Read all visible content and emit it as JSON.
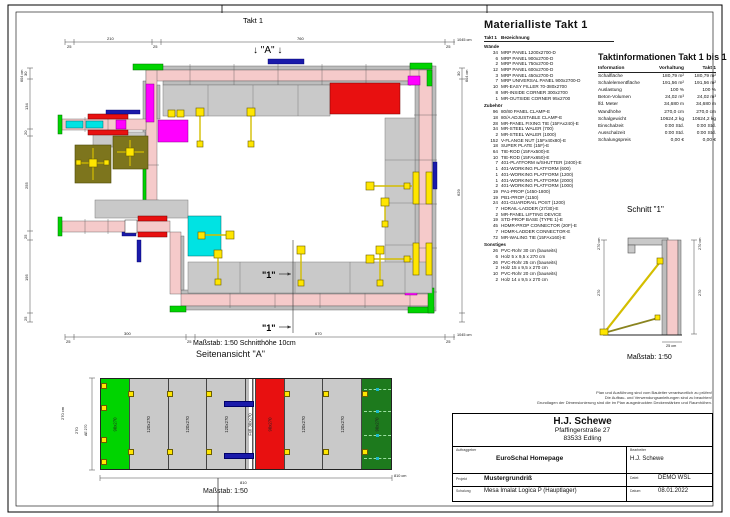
{
  "plan": {
    "title": "Takt 1",
    "view_arrow_label": "↓ \"A\" ↓",
    "section_marker": "\"1\"",
    "scale_note": "Maßstab: 1:50   Schnitthöhe 10cm",
    "dims": {
      "top": [
        "25",
        "210",
        "25",
        "760",
        "25"
      ],
      "top_total": "1045 cm",
      "left": [
        "30",
        "134",
        "20",
        "255",
        "25",
        "195",
        "25"
      ],
      "left_total": "604 cm",
      "right_seg1": "30",
      "right_seg2": "629",
      "right_total": "604 cm",
      "bottom": [
        "25",
        "300",
        "25",
        "670",
        "25"
      ],
      "bottom_total": "1045 cm"
    }
  },
  "side_view": {
    "title": "Seitenansicht \"A\"",
    "scale": "Maßstab: 1:50",
    "dim_left_total": "270 cm",
    "dim_left": "270",
    "edge_label": "AE 270",
    "dim_bottom": "810",
    "dim_bottom_total": "810 cm",
    "panels": [
      {
        "label": "90x270",
        "type": "green"
      },
      {
        "label": "120x270",
        "type": "gray"
      },
      {
        "label": "120x270",
        "type": "gray"
      },
      {
        "label": "120x270",
        "type": "gray"
      },
      {
        "label": "Füll 30x270",
        "type": "filler"
      },
      {
        "label": "90x270",
        "type": "red"
      },
      {
        "label": "120x270",
        "type": "gray"
      },
      {
        "label": "120x270",
        "type": "gray"
      },
      {
        "label": "90x270",
        "type": "darkgreen"
      }
    ]
  },
  "schnitt": {
    "title": "Schnitt \"1\"",
    "scale": "Maßstab: 1:50",
    "dim_left_total": "270 cm",
    "dim_left": "270",
    "dim_right_total": "270 cm",
    "dim_right": "270",
    "dim_bottom": "25 cm"
  },
  "material_list": {
    "title": "Materialliste  Takt 1",
    "col_takt": "Takt 1",
    "col_name": "Bezeichnung",
    "rows": [
      {
        "qty": "",
        "name": "Wände",
        "cls": "group"
      },
      {
        "qty": "34",
        "name": "MRP PANEL 1200x2700-D",
        "cls": "item"
      },
      {
        "qty": "6",
        "name": "MRP PANEL 900x2700-D",
        "cls": "item"
      },
      {
        "qty": "2",
        "name": "MRP PANEL 750x2700-D",
        "cls": "item"
      },
      {
        "qty": "12",
        "name": "MRP PANEL 600x2700-D",
        "cls": "item"
      },
      {
        "qty": "3",
        "name": "MRP PANEL 450x2700-D",
        "cls": "item"
      },
      {
        "qty": "7",
        "name": "MRP UNIVERSAL PANEL 900x2700-D",
        "cls": "item"
      },
      {
        "qty": "10",
        "name": "MR-EASY FILLER 70-380x2700",
        "cls": "item"
      },
      {
        "qty": "8",
        "name": "MR-INSIDE CORNER 300x2700",
        "cls": "item"
      },
      {
        "qty": "1",
        "name": "MR-OUTSIDE CORNER 95x2700",
        "cls": "item"
      },
      {
        "qty": "",
        "name": "Zubehör",
        "cls": "group"
      },
      {
        "qty": "96",
        "name": "80/80 PANEL CLAMP-E",
        "cls": "item"
      },
      {
        "qty": "18",
        "name": "80/A ADJUSTABLE CLAMP-E",
        "cls": "item"
      },
      {
        "qty": "28",
        "name": "MR-PANEL FIXING TIE (15FAx240)-E",
        "cls": "item"
      },
      {
        "qty": "34",
        "name": "MR-STEEL WALER (700)",
        "cls": "item"
      },
      {
        "qty": "2",
        "name": "MR-STEEL WALER (1000)",
        "cls": "item"
      },
      {
        "qty": "152",
        "name": "V-FLANGE NUT (15Fx40x80)-E",
        "cls": "item"
      },
      {
        "qty": "18",
        "name": "SUPER PLATE (15F)-E",
        "cls": "item"
      },
      {
        "qty": "64",
        "name": "TIE-ROD (15FAx500)-E",
        "cls": "item"
      },
      {
        "qty": "10",
        "name": "TIE-ROD (15FAx650)-E",
        "cls": "item"
      },
      {
        "qty": "7",
        "name": "401-PLATFORM w/SHUTTER (2400)-E",
        "cls": "item"
      },
      {
        "qty": "1",
        "name": "401-WORKING PLATFORM (600)",
        "cls": "item"
      },
      {
        "qty": "1",
        "name": "401-WORKING PLATFORM (1200)",
        "cls": "item"
      },
      {
        "qty": "1",
        "name": "401-WORKING PLATFORM (2000)",
        "cls": "item"
      },
      {
        "qty": "2",
        "name": "401-WORKING PLATFORM (1000)",
        "cls": "item"
      },
      {
        "qty": "19",
        "name": "PA1-PROP (1450-1800)",
        "cls": "item"
      },
      {
        "qty": "19",
        "name": "PB1-PROP (1150)",
        "cls": "item"
      },
      {
        "qty": "24",
        "name": "401-GUARDRAIL POST (1200)",
        "cls": "item"
      },
      {
        "qty": "7",
        "name": "HDRAIL-LADDER (27/30)-E",
        "cls": "item"
      },
      {
        "qty": "2",
        "name": "MR-PANEL LIFTING DEVICE",
        "cls": "item"
      },
      {
        "qty": "19",
        "name": "STD-PROP BASE (TYPE 1)-E",
        "cls": "item"
      },
      {
        "qty": "45",
        "name": "HDMR-PROP CONNECTOR (20F)-E",
        "cls": "item"
      },
      {
        "qty": "7",
        "name": "HDMR-LADDER CONNECTOR-E",
        "cls": "item"
      },
      {
        "qty": "72",
        "name": "MR-WALING TIE (15FAx160)-E",
        "cls": "item"
      },
      {
        "qty": "",
        "name": "Sonstiges",
        "cls": "group"
      },
      {
        "qty": "26",
        "name": "PVC-Rohr 30 cm (bauseits)",
        "cls": "item"
      },
      {
        "qty": "6",
        "name": "Holz 5 x 9,5 x 270 cm",
        "cls": "item"
      },
      {
        "qty": "26",
        "name": "PVC-Rohr 25 cm (bauseits)",
        "cls": "item"
      },
      {
        "qty": "2",
        "name": "Holz 15 x 9,5 x 270 cm",
        "cls": "item"
      },
      {
        "qty": "10",
        "name": "PVC-Rohr 20 cm (bauseits)",
        "cls": "item"
      },
      {
        "qty": "2",
        "name": "Holz 14 x 9,5 x 270 cm",
        "cls": "item"
      }
    ]
  },
  "takt_info": {
    "title": "Taktinformationen  Takt 1 bis 1",
    "col_label": "Information",
    "col_v1": "Vorhaltung",
    "col_v2": "Takt 1",
    "rows": [
      {
        "label": "Schalfläche",
        "v1": "180,79 m²",
        "v2": "180,79 m²"
      },
      {
        "label": "Schalelementfläche",
        "v1": "191,56 m²",
        "v2": "191,56 m²"
      },
      {
        "label": "Auslastung",
        "v1": "100 %",
        "v2": "100 %"
      },
      {
        "label": "Beton-Volumen",
        "v1": "24,02 m³",
        "v2": "24,02 m³"
      },
      {
        "label": "lfd. Meter",
        "v1": "34,680 m",
        "v2": "34,680 m"
      },
      {
        "label": "Wandhöhe",
        "v1": "270,0 cm",
        "v2": "270,0 cm"
      },
      {
        "label": "Schalgewicht",
        "v1": "10624,2 kg",
        "v2": "10624,2 kg"
      },
      {
        "label": "Einschalzeit",
        "v1": "0:00 Std.",
        "v2": "0:00 Std."
      },
      {
        "label": "Ausschalzeit",
        "v1": "0:00 Std.",
        "v2": "0:00 Std."
      },
      {
        "label": "Schalungspreis",
        "v1": "0,00 €",
        "v2": "0,00 €"
      }
    ]
  },
  "disclaimer": {
    "line1": "Plan und Ausführung sind vom Bauleiter verantwortlich zu prüfen!",
    "line2": "Die Aufbau- und Verwendungsanleitungen sind zu beachten!",
    "line3": "Grundlagen der Dimensionierung sind die im Plan ausgedruckten Deckenstärken und Raumhöhen."
  },
  "title_block": {
    "company": "H.J. Schewe",
    "street": "Pfaffingerstraße 27",
    "city": "83533 Edling",
    "client_label": "Auftraggeber",
    "client": "EuroSchal Homepage",
    "editor_label": "Bearbeiter",
    "editor": "H.J. Schewe",
    "project_label": "Projekt",
    "project": "Mustergrundriß",
    "file_label": "Datei:",
    "file": "DEMO WSL",
    "formwork_label": "Schalung",
    "formwork": "Mesa Imalat Logica P (Hauptlager)",
    "date_label": "Datum:",
    "date": "08.01.2022"
  },
  "colors": {
    "wall_pink": "#f5caca",
    "panel_gray": "#c9c9c9",
    "accent_green": "#00d400",
    "accent_red": "#e81010",
    "accent_magenta": "#ff00ff",
    "accent_cyan": "#00e3e3",
    "accent_yellow": "#ffe600",
    "accent_olive": "#7d751d",
    "accent_blue": "#1a1aaa"
  }
}
